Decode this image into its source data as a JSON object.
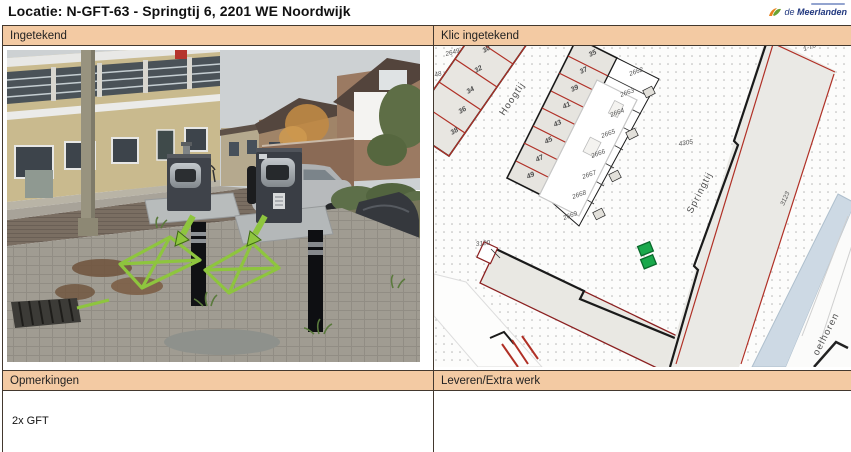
{
  "title": "Locatie: N-GFT-63 - Springtij 6, 2201 WE Noordwijk",
  "logo": {
    "prefix": "de",
    "name": "Meerlanden"
  },
  "panels": {
    "photo": {
      "header": "Ingetekend"
    },
    "map": {
      "header": "Klic ingetekend"
    },
    "remarks": {
      "header": "Opmerkingen",
      "content": "2x GFT"
    },
    "delivery": {
      "header": "Leveren/Extra werk",
      "content": ""
    }
  },
  "map_labels": {
    "streets": [
      "Hoogtij",
      "Springtij"
    ],
    "street_partial": "oelhoren",
    "house_numbers_left": [
      "30",
      "32",
      "34",
      "36",
      "38"
    ],
    "house_numbers_right": [
      "35",
      "37",
      "39",
      "41",
      "43",
      "45",
      "47",
      "49"
    ],
    "parcels_left": [
      "2649",
      "48"
    ],
    "parcels_right": [
      "2662",
      "2663",
      "2664",
      "2665",
      "2666",
      "2667",
      "2668",
      "2669"
    ],
    "ids": {
      "building": "3120",
      "parcel": "3123",
      "flat": "4305",
      "range": "1-76"
    }
  },
  "annotations": {
    "photo_marks": "2 green X-marked placement squares with arrows",
    "map_marker": "2 green container squares"
  },
  "colors": {
    "header_bg": "#f3caa3",
    "border": "#43382e",
    "annotation_green": "#8ec53e",
    "marker_green": "#19a84b",
    "cadastral_red": "#b03026",
    "water_blue": "#cdd9e4"
  }
}
